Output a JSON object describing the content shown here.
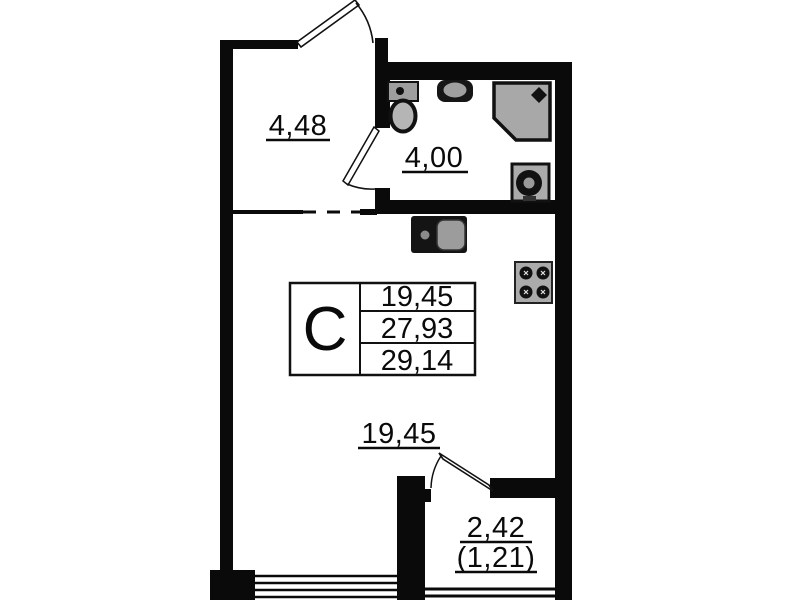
{
  "floorplan": {
    "unit_table": {
      "letter": "C",
      "values": [
        "19,45",
        "27,93",
        "29,14"
      ]
    },
    "labels": {
      "hallway_area": "4,48",
      "bathroom_area": "4,00",
      "living_area": "19,45",
      "balcony_area": "2,42",
      "balcony_area_reduced": "(1,21)"
    },
    "fixtures": [
      "toilet",
      "bathroom-sink",
      "shower-cabin",
      "washing-machine",
      "kitchen-sink",
      "stove"
    ],
    "colors": {
      "wall": "#0a0a0a",
      "background": "#ffffff",
      "fixture_gray": "#a8a8a8"
    }
  }
}
